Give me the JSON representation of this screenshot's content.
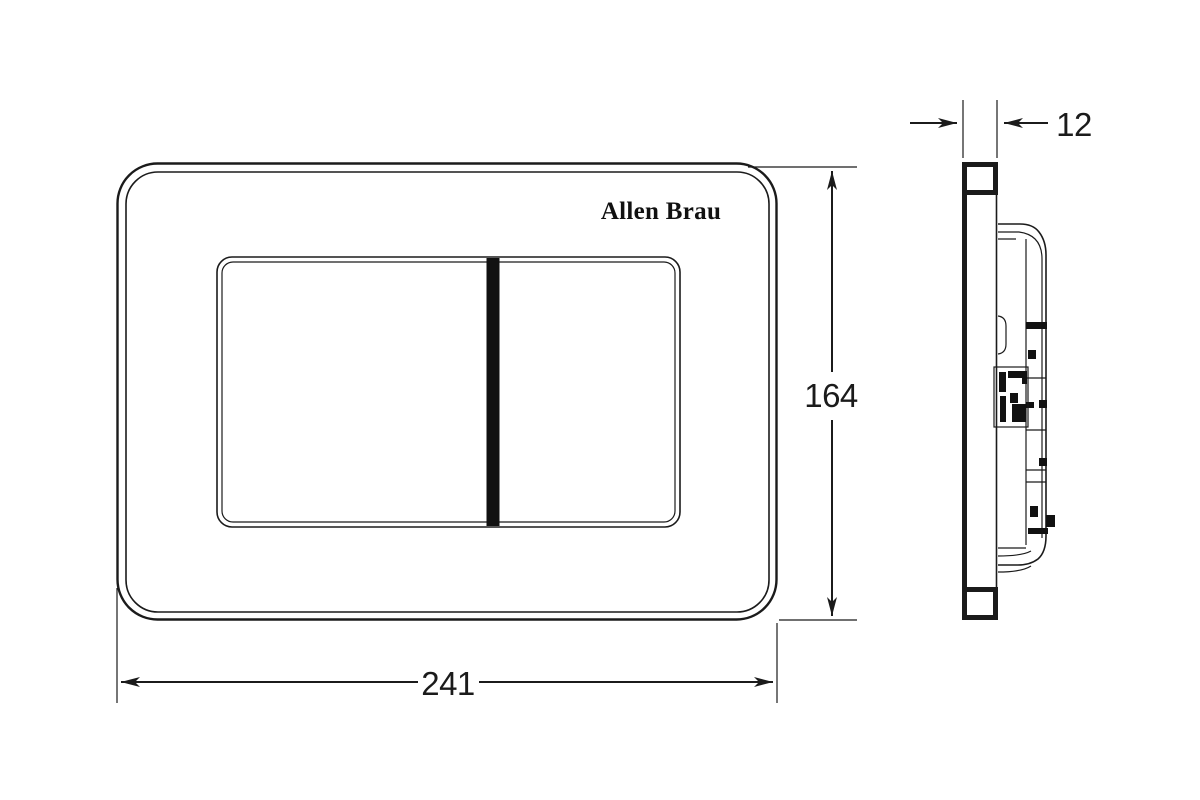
{
  "colors": {
    "background": "#ffffff",
    "line": "#1b1b1b"
  },
  "front_view": {
    "logo": "Allen Brau"
  },
  "dimensions": {
    "width": {
      "value": "241"
    },
    "height": {
      "value": "164"
    },
    "thickness": {
      "value": "12"
    }
  }
}
